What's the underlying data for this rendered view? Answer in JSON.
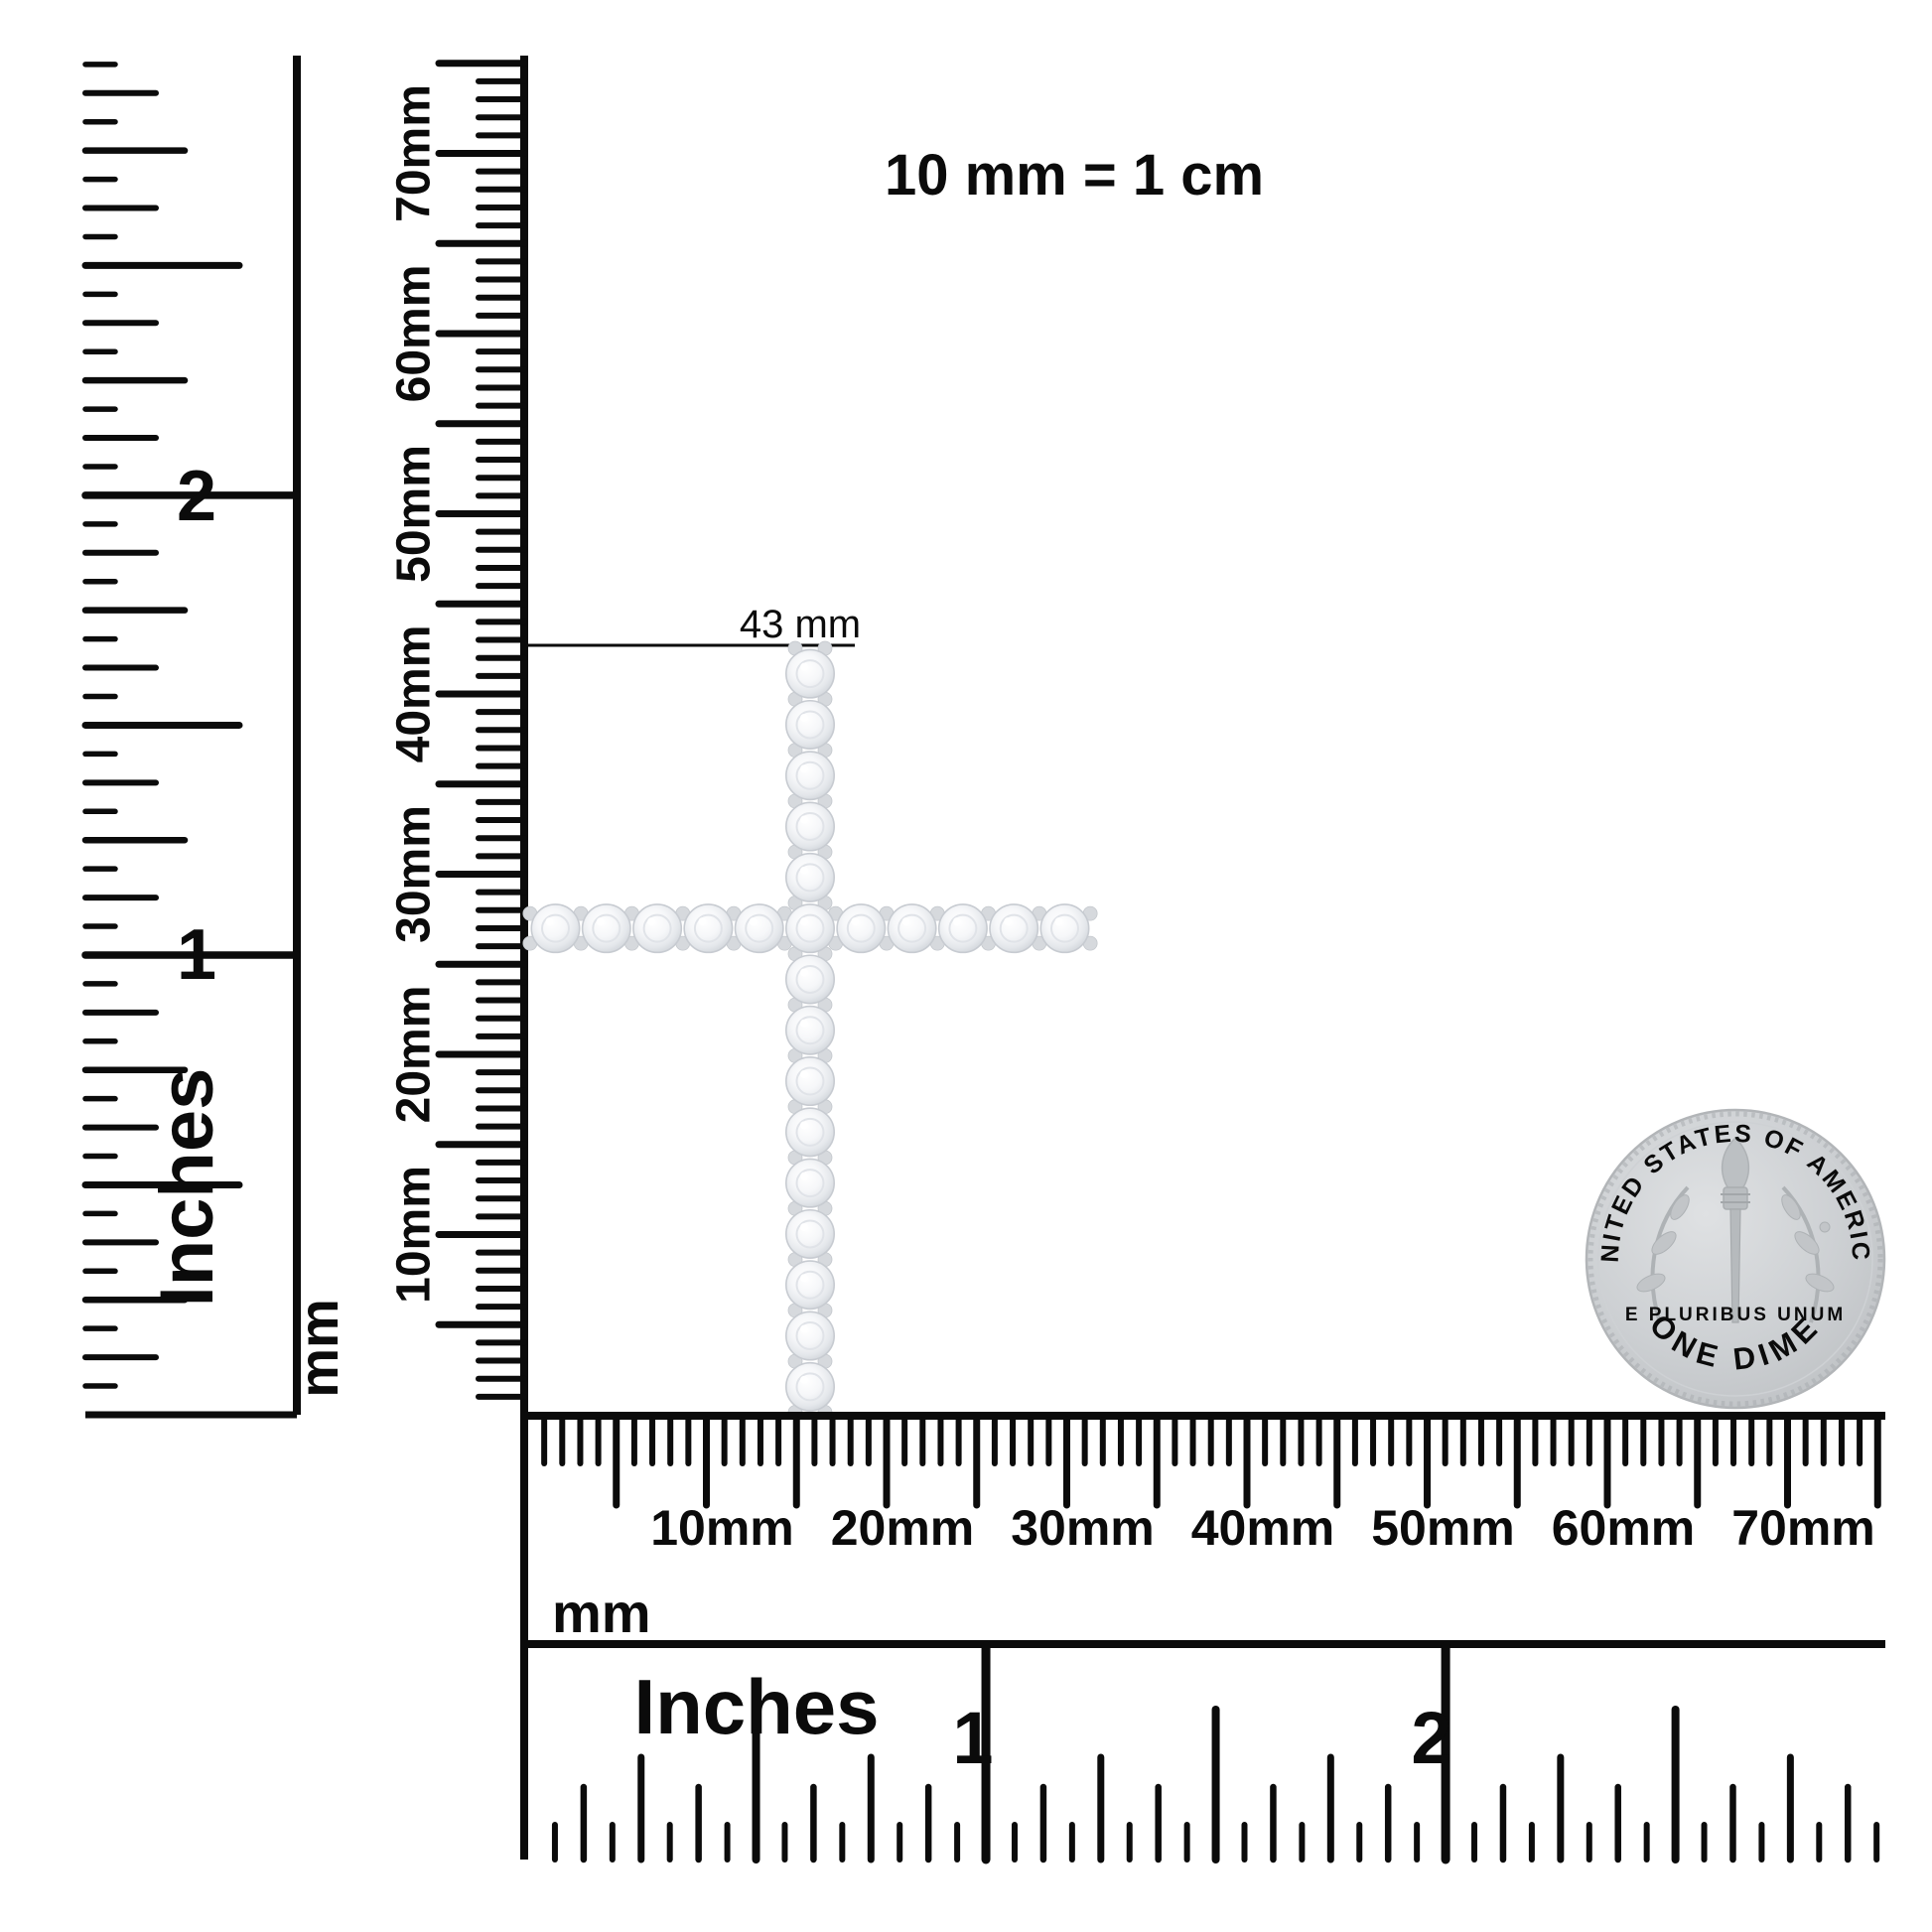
{
  "canvas": {
    "bg": "#ffffff",
    "ink": "#0b0b0b"
  },
  "header": {
    "scale_note": "10 mm = 1 cm"
  },
  "annotation": {
    "height_label": "43 mm"
  },
  "left_inch_ruler": {
    "caption": "Inches",
    "numerals": [
      "1",
      "2"
    ]
  },
  "left_mm_ruler": {
    "caption": "mm",
    "labels": [
      "10mm",
      "20mm",
      "30mm",
      "40mm",
      "50mm",
      "60mm",
      "70mm"
    ]
  },
  "bottom_mm_ruler": {
    "caption": "mm",
    "labels": [
      "10mm",
      "20mm",
      "30mm",
      "40mm",
      "50mm",
      "60mm",
      "70mm"
    ]
  },
  "bottom_inch_ruler": {
    "caption": "Inches",
    "numerals": [
      "1",
      "2"
    ]
  },
  "pendant": {
    "kind": "diamond-cross-pendant",
    "stones_vertical": 15,
    "stones_horizontal": 11,
    "measured_height": "43 mm",
    "stone_edge": "#c7cbd1",
    "stone_inner": "#e0e3e8",
    "prong": "#d6d9dd"
  },
  "coin": {
    "kind": "US dime reverse",
    "top_text": "UNITED STATES OF AMERICA",
    "bottom_text": "ONE DIME",
    "middle_text": "E PLURIBUS UNUM",
    "base": "#cdd0d3",
    "detail": "#a8acb0"
  }
}
